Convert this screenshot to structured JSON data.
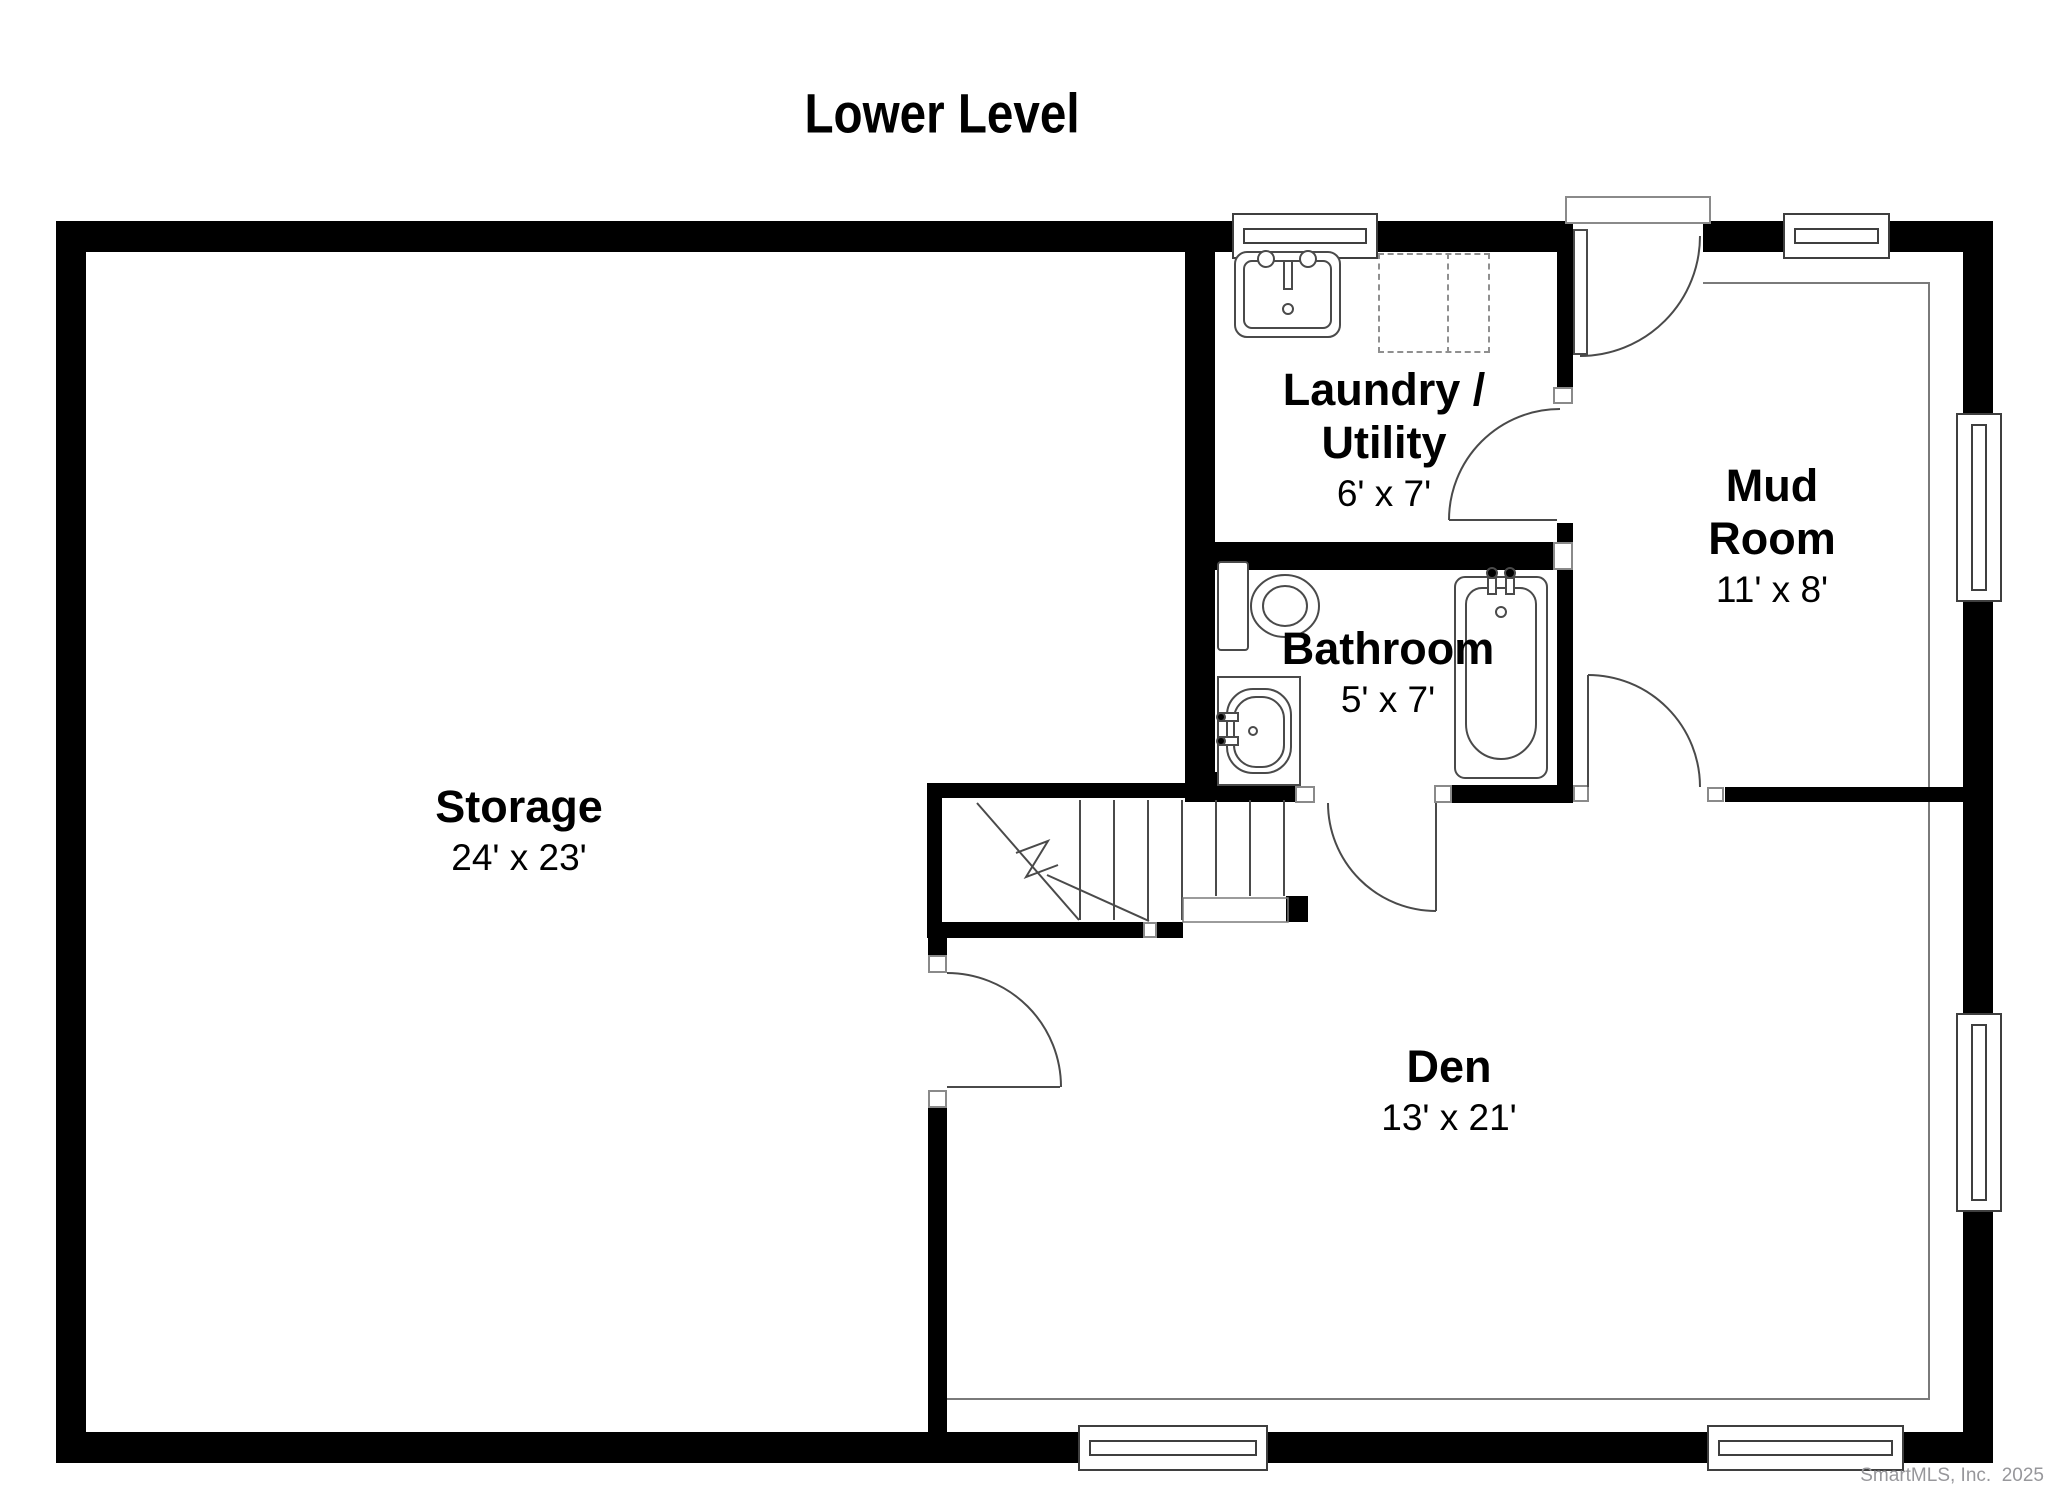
{
  "title": "Lower Level",
  "watermark": "SmartMLS, Inc.  2025",
  "colors": {
    "wall": "#000000",
    "fixture_line": "#4a4a4a",
    "thin_floor_line": "#7a7a7a",
    "watermark": "#97979b"
  },
  "rooms": [
    {
      "id": "storage",
      "name_lines": [
        "Storage"
      ],
      "dims": "24' x 23'"
    },
    {
      "id": "laundry",
      "name_lines": [
        "Laundry /",
        "Utility"
      ],
      "dims": "6' x 7'"
    },
    {
      "id": "bathroom",
      "name_lines": [
        "Bathroom"
      ],
      "dims": "5' x 7'"
    },
    {
      "id": "mudroom",
      "name_lines": [
        "Mud",
        "Room"
      ],
      "dims": "11' x 8'"
    },
    {
      "id": "den",
      "name_lines": [
        "Den"
      ],
      "dims": "13' x 21'"
    }
  ],
  "fixtures": [
    "laundry-sink",
    "washer-dryer-area",
    "toilet",
    "vanity-sink",
    "bathtub",
    "staircase"
  ],
  "doors": [
    "mudroom-entry-door",
    "laundry-mudroom-door",
    "bathroom-door",
    "mudroom-den-door",
    "storage-den-door"
  ],
  "windows": [
    "laundry-top-window",
    "mudroom-top-window",
    "mudroom-right-window",
    "den-right-window",
    "den-bottom-window-left",
    "den-bottom-window-right"
  ]
}
